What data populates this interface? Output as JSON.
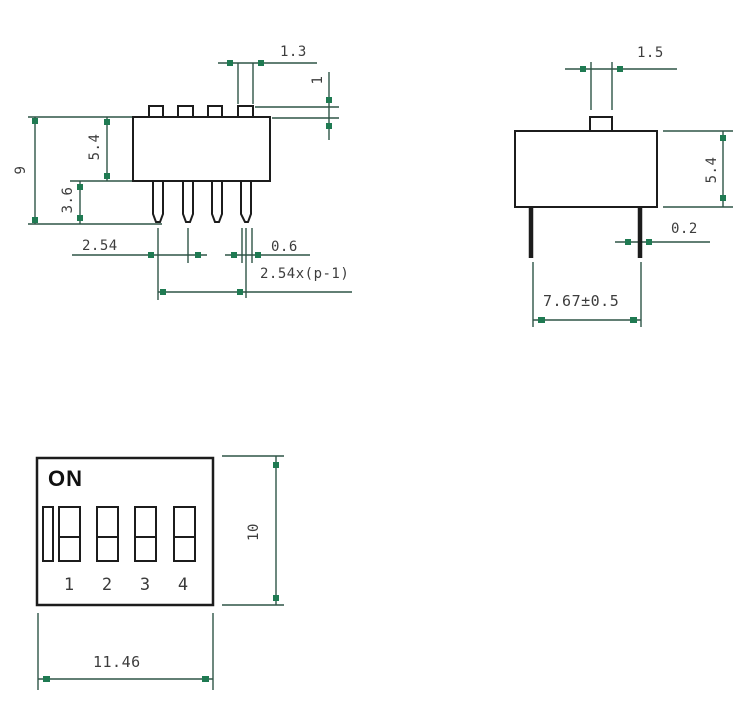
{
  "colors": {
    "bg": "#ffffff",
    "outline": "#1c1c1c",
    "dimline": "#2e5547",
    "marker": "#1f7a52",
    "dimtext": "#3d3d3d"
  },
  "front_view": {
    "dims": {
      "actuator_width": "1.3",
      "actuator_height": "1",
      "total_height": "9",
      "body_height": "5.4",
      "pin_length": "3.6",
      "pin_pitch": "2.54",
      "pin_width": "0.6",
      "pin_span_formula": "2.54x(p-1)"
    }
  },
  "side_view": {
    "dims": {
      "knob_width": "1.5",
      "body_height": "5.4",
      "pin_thickness": "0.2",
      "pin_span": "7.67±0.5"
    }
  },
  "top_view": {
    "on_label": "ON",
    "switch_numbers": [
      "1",
      "2",
      "3",
      "4"
    ],
    "dims": {
      "body_depth": "10",
      "body_width": "11.46"
    }
  }
}
